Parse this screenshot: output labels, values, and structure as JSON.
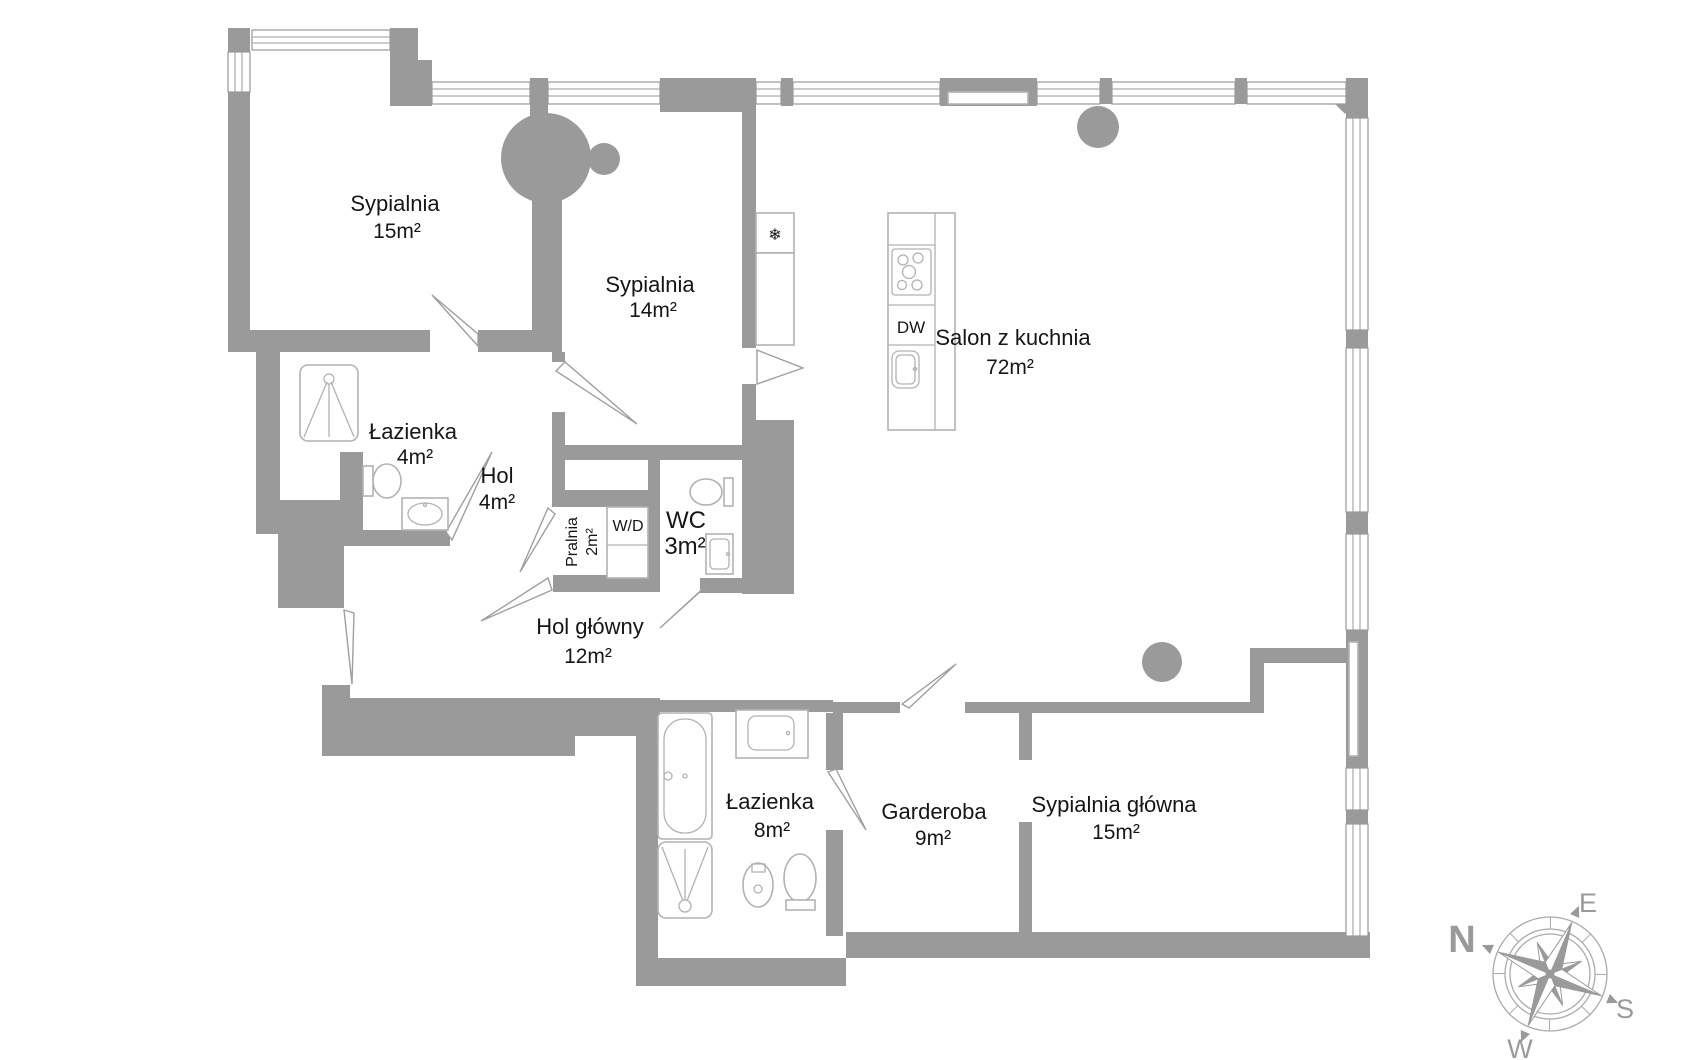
{
  "rooms": {
    "sypialnia_15": {
      "name": "Sypialnia",
      "area": "15m²"
    },
    "sypialnia_14": {
      "name": "Sypialnia",
      "area": "14m²"
    },
    "salon": {
      "name": "Salon z kuchnia",
      "area": "72m²"
    },
    "lazienka_4": {
      "name": "Łazienka",
      "area": "4m²"
    },
    "hol": {
      "name": "Hol",
      "area": "4m²"
    },
    "pralnia": {
      "name": "Pralnia",
      "area": "2m²"
    },
    "wc": {
      "name": "WC",
      "area": "3m²"
    },
    "hol_glowny": {
      "name": "Hol główny",
      "area": "12m²"
    },
    "lazienka_8": {
      "name": "Łazienka",
      "area": "8m²"
    },
    "garderoba": {
      "name": "Garderoba",
      "area": "9m²"
    },
    "sypialnia_glowna": {
      "name": "Sypialnia główna",
      "area": "15m²"
    }
  },
  "labels": {
    "dishwasher": "DW",
    "washer_dryer": "W/D",
    "fridge_icon": "❄"
  },
  "compass": {
    "north": "N",
    "east": "E",
    "south": "S",
    "west": "W"
  },
  "colors": {
    "wall": "#9a9a9a",
    "fixture": "#b2b2b2",
    "text": "#161616"
  }
}
